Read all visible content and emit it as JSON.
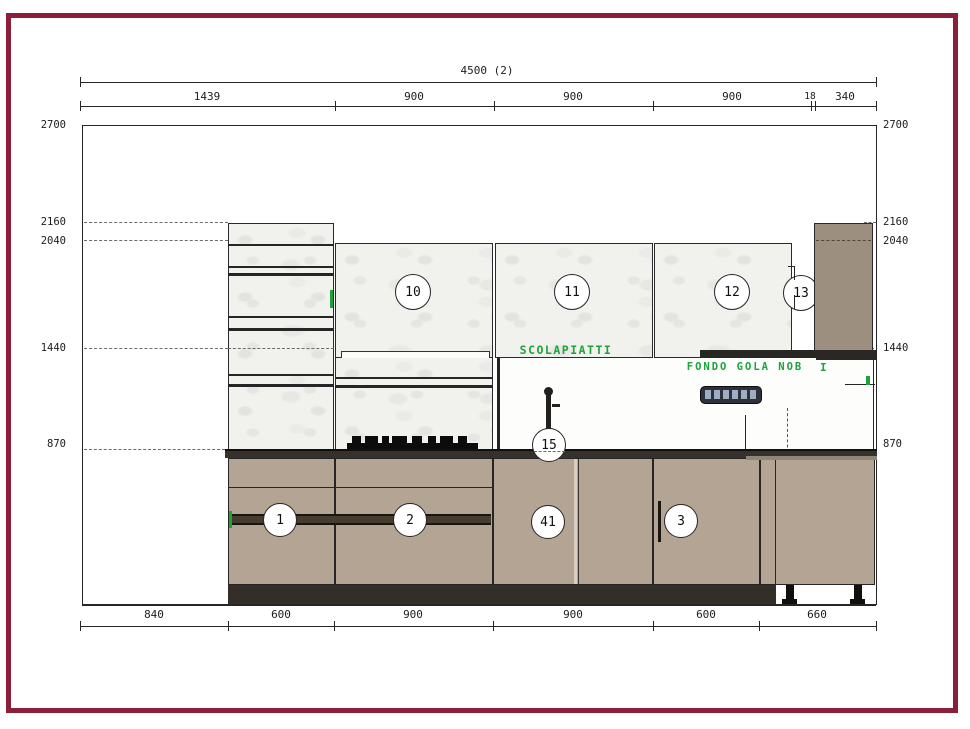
{
  "drawing": {
    "title_dim": "4500 (2)",
    "top_dims": [
      "1439",
      "900",
      "900",
      "900",
      "18",
      "340"
    ],
    "bottom_dims": [
      "840",
      "600",
      "900",
      "900",
      "600",
      "660"
    ],
    "left_heights": [
      "2700",
      "2160",
      "2040",
      "1440",
      "870"
    ],
    "right_heights": [
      "2700",
      "2160",
      "2040",
      "1440",
      "870"
    ],
    "badges": {
      "b10": "10",
      "b11": "11",
      "b12": "12",
      "b13": "13",
      "b1": "1",
      "b2": "2",
      "b41": "41",
      "b3": "3",
      "b15": "15"
    },
    "notes": {
      "scolapiatti": "SCOLAPIATTI",
      "fondo_gola": "FONDO GOLA NOB",
      "fondo_gola_mark": "I"
    },
    "colors": {
      "frame": "#8b1f3a",
      "cabinet_taupe": "#b3a493",
      "tall_cabinet": "#9c8f7f",
      "countertop": "#36312b",
      "toe_kick": "#332e27",
      "note_green": "#1da33c",
      "marble": "#f1f1ee"
    }
  }
}
